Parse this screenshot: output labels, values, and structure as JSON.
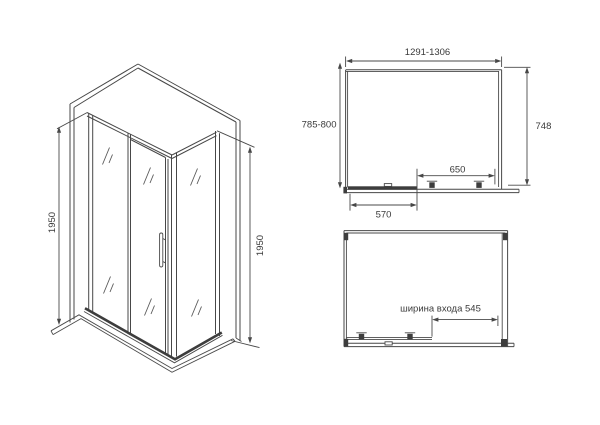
{
  "title": "Shower enclosure dimensional drawing",
  "colors": {
    "line": "#474747",
    "text": "#3a3a3a",
    "background": "#ffffff"
  },
  "views": {
    "isometric": {
      "dim_height_left": "1950",
      "dim_height_right": "1950"
    },
    "front": {
      "dim_total_width": "1291-1306",
      "dim_side_depth": "785-800",
      "dim_glass_height": "748",
      "dim_door_width": "650",
      "dim_fixed_panel_width": "570"
    },
    "plan": {
      "dim_entrance_width": "ширина входа 545"
    }
  }
}
